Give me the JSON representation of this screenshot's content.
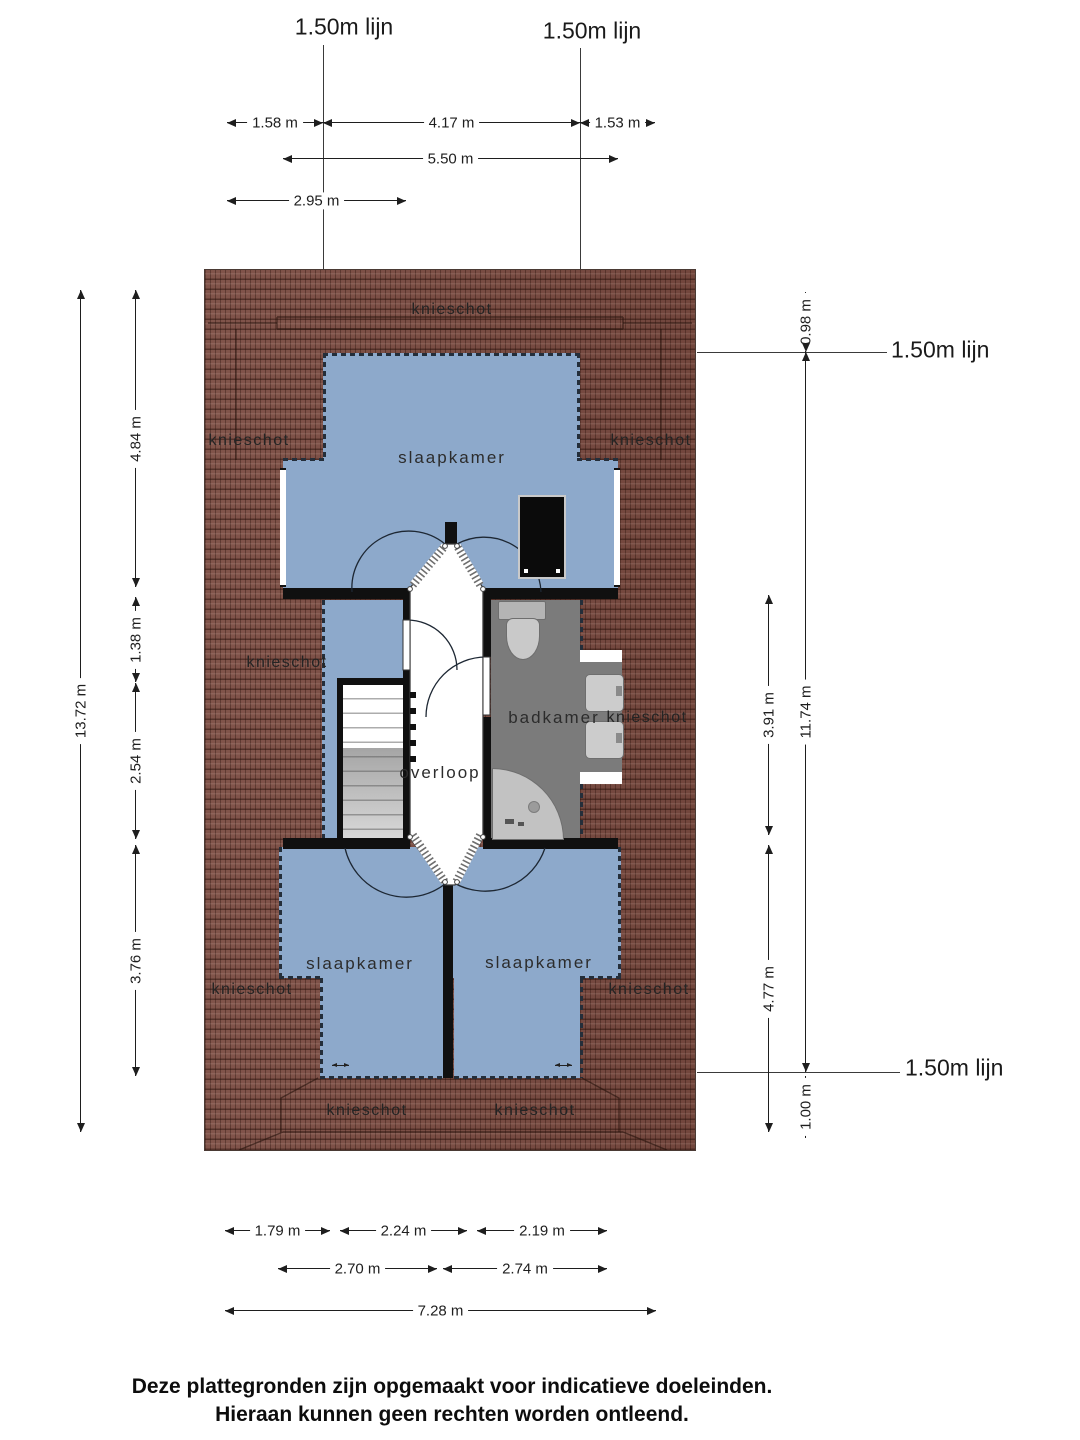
{
  "reference_line_label": "1.50m lijn",
  "rooms": {
    "bedroom": "slaapkamer",
    "bathroom": "badkamer",
    "landing": "overloop",
    "knee_wall": "knieschot"
  },
  "dimensions": {
    "top": [
      "1.58 m",
      "4.17 m",
      "1.53 m",
      "5.50 m",
      "2.95 m"
    ],
    "left": [
      "13.72 m",
      "4.84 m",
      "1.38 m",
      "2.54 m",
      "3.76 m"
    ],
    "right": [
      "0.98 m",
      "3.91 m",
      "11.74 m",
      "4.77 m",
      "1.00 m"
    ],
    "bottom": [
      "1.79 m",
      "2.24 m",
      "2.19 m",
      "2.70 m",
      "2.74 m",
      "7.28 m"
    ]
  },
  "footer": {
    "line1": "Deze plattegronden zijn opgemaakt voor indicatieve doeleinden.",
    "line2": "Hieraan kunnen geen rechten worden ontleend."
  },
  "colors": {
    "room_fill": "#8DA9CB",
    "roof": "#7A4B41",
    "bathroom_floor": "#7B7B7B",
    "wall": "#101010",
    "knee_wall_dash": "#242E3A"
  }
}
